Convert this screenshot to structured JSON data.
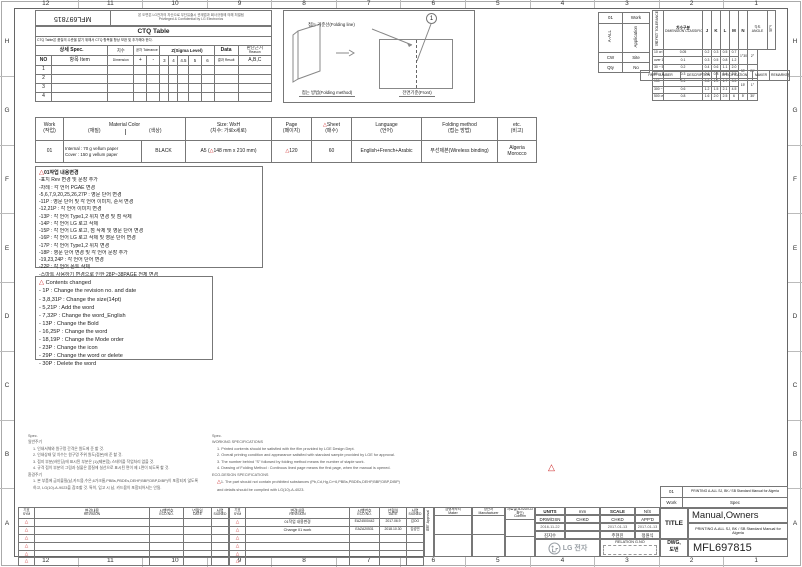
{
  "colors": {
    "accent_red": "#cc2222",
    "line_gray": "#777777",
    "logo_gray": "#9aa0a6"
  },
  "frame": {
    "cols": [
      "12",
      "11",
      "10",
      "9",
      "8",
      "7",
      "6",
      "5",
      "4",
      "3",
      "2",
      "1"
    ],
    "rows": [
      "H",
      "G",
      "F",
      "E",
      "D",
      "C",
      "B",
      "A"
    ]
  },
  "header": {
    "doc_number_flipped": "MFL697815",
    "notice_ko": "본 도면은 LG전자의 자산으로 무단유출시 관계법과 회사규정에 의해 처벌됨",
    "notice_en": "Privileged & Confidential by LG Electronics"
  },
  "ctq": {
    "title": "CTQ Table",
    "note": "CTQ Table은 품질의 수준을 알기 위해서 CTQ 항목을 항상 보완 및 추가해야 한다.",
    "headers": {
      "spec": "상세 Spec.",
      "no": "NO",
      "item": "항목 Item",
      "dim": "치수",
      "dim_sub": "Dimension",
      "tol": "공차 Tolerance",
      "plus": "+",
      "minus": "-",
      "sigma": "Z(Sigma Level)",
      "sigma_levels": [
        "3",
        "4",
        "4.5",
        "5",
        "6"
      ],
      "data_label": "Data",
      "result": "결과 Result",
      "reason_ko": "판단근거",
      "reason_en": "Reason",
      "abc": "A,B,C"
    },
    "row_numbers": [
      "1",
      "2",
      "3",
      "4"
    ]
  },
  "folding_diagram": {
    "callout": "1",
    "folding_line_label": "접는 기준선(Folding line)",
    "method_label": "접는 방법(Folding method)",
    "front_label": "전면기준(Front)"
  },
  "work_table": {
    "rows": [
      [
        "01",
        "Work"
      ],
      [
        "A-ALL",
        "Application"
      ],
      [
        "CW",
        "Site"
      ],
      [
        "Qty",
        "No"
      ]
    ]
  },
  "tolerance_table": {
    "side_label": "일반공차 TOLERANCE",
    "title_ko": "치수구분",
    "title_en": "DIMENSION CLASSIFICATION",
    "cols": [
      "J",
      "K",
      "L",
      "M",
      "N"
    ],
    "angle_ko": "각도",
    "angle_en": "ANGLE",
    "remark": "비고",
    "rows": [
      {
        "range": "10 or less",
        "values": [
          "0.05",
          "0.2",
          "0.3",
          "0.5",
          "0.7"
        ]
      },
      {
        "range": "over 10 ~ 30 or less",
        "values": [
          "0.1",
          "0.3",
          "0.5",
          "0.8",
          "1.2"
        ]
      },
      {
        "range": "30 ~ 50",
        "values": [
          "0.2",
          "0.4",
          "0.6",
          "1.1",
          "2.0"
        ]
      },
      {
        "range": "50 ~ 150",
        "values": [
          "0.3",
          "0.6",
          "0.8",
          "1.4",
          "2.5"
        ]
      },
      {
        "range": "150 ~ 300",
        "values": [
          "0.4",
          "0.8",
          "1.0",
          "1.7",
          "3.5"
        ]
      },
      {
        "range": "300 ~ 500",
        "values": [
          "0.6",
          "1.2",
          "1.5",
          "2.1",
          "4.5"
        ]
      },
      {
        "range": "500 over",
        "values": [
          "0.8",
          "1.6",
          "2.0",
          "2.5",
          "6"
        ]
      }
    ],
    "angle_values": [
      [
        "1°30′",
        "2°"
      ],
      [
        "30′",
        "20′"
      ],
      [
        "15′",
        "1°"
      ],
      [
        "5′",
        "30′"
      ]
    ]
  },
  "part_row": {
    "labels": [
      "PART NUMBER",
      "DESCRIPTION",
      "SPECIFICATION",
      "MAKER",
      "REMARKER"
    ]
  },
  "spec_table": {
    "h": {
      "work_en": "Work",
      "work_ko": "(작업)",
      "material_en": "Material Color",
      "material_ko": "(재질)",
      "color_ko": "(색상)",
      "size_en": "Size: WxH",
      "size_ko": "(치수: 가로x세로)",
      "page_en": "Page",
      "page_ko": "(페이지)",
      "sheet_en": "Sheet",
      "sheet_ko": "(매수)",
      "lang_en": "Language",
      "lang_ko": "(언어)",
      "fold_en": "Folding method",
      "fold_ko": "(접는 방법)",
      "etc_en": "etc.",
      "etc_ko": "(비고)"
    },
    "row": {
      "work": "01",
      "material_line1": "Internal : 70 g vellum paper",
      "material_line2": "Cover : 150 g vellum paper",
      "color": "BLACK",
      "size_prefix": "A5 (",
      "size_marked": "148",
      "size_suffix": " mm x 210 mm)",
      "page": "120",
      "sheet": "60",
      "language": "English+French+Arabic",
      "folding": "무선제본(Wireless binding)",
      "etc_line1": "Algeria",
      "etc_line2": "Morocco"
    }
  },
  "changes_ko": {
    "title": "01작업 내용변경",
    "lines": [
      "-표지 Rev 변경 및 문장 추가",
      "-차례 : 각 언어 PGAE 변경",
      "-5,6,7,9,20,25,26,27P : 영문 단어 변경",
      "-11P : 영문 단어 및 각 언어 이미지, 순서 변경",
      "-12,21P : 각 언어 이미지 변경",
      "-13P : 각 언어 Type1,2 위치 변경 및 점 삭제",
      "-14P : 각 언어 LG 로고 삭제",
      "-15P : 각 언어 LG 로고, 점 삭제 및 영문 단어 변경",
      "-16P : 각 언어 LG 로고 삭제 및 영문 단어 변경",
      "-17P : 각 언어 Type1,2 위치 변경",
      "-18P : 영문 단어 변경 및 각 언어 문장 추가",
      "-19,23,24P : 각 언어 단어 변경",
      "-22P : 각 언어 폰트 삭제",
      "-스마트 사용하기 변경으로 인한 28P~38PAGE 전체 변경"
    ]
  },
  "changes_en": {
    "title": "Contents changed",
    "lines": [
      "- 1P : Change the revision no. and date",
      "- 3,8,31P : Change the size(14pt)",
      "- 5,21P : Add the word",
      "- 7,32P : Change the word_English",
      "- 13P : Change the Bold",
      "- 16,25P : Change the word",
      "- 18,19P : Change the Mode order",
      "- 23P : Change the icon",
      "- 29P : Change the word or delete",
      "- 30P : Delete the word"
    ]
  },
  "notes_left": {
    "title": "Spec.",
    "sections": [
      {
        "heading": "일반주기",
        "lines": [
          "1. 인쇄서체와 원구멍 간격은 원도에 준 할 것.",
          "2. 인쇄상태 및 치수는 원구멍 주위 원도(접본)에 준 할 것.",
          "3. 접지 부분(바인딩)에 표시된 부분은 (1)(제본점) 스테이플 작업처리 없을 것.",
          "4. 규격 접이 부분의 그림과 실물은 품질에 실선으로 표시된 면이 제 1면이 되도록 할 것."
        ]
      },
      {
        "heading": "환경주기",
        "lines": [
          "1. 본 부품에 금지물질(납,카드뮴,수은,6가크롬,PBBs,PBDEs,DEHP,BBP,DBP,DIBP)이 포함되지 않도록",
          "    하고, LG(10)-A-9023을 참조할 것. 특히, 입고 시 납, 카드뮴이 포함되어서는 안됨."
        ]
      }
    ]
  },
  "notes_mid": {
    "title": "Spec.",
    "sections": [
      {
        "heading": "WORKING SPECIFICATIONS",
        "lines": [
          "1. Printed contents should be satisfied with the film provided by LGE Design Dept.",
          "2. Overall printing condition and appearance satisfied with standard sample provided by LGE for approval.",
          "3. The number behind \"S\" followed by folding method means the number of staple work.",
          "4. Drawing of Folding Method : Continous lined page means the first page, when the manual is opened."
        ]
      },
      {
        "heading": "ECO-DESIGN SPECIFICATIONS",
        "tri_first": true,
        "lines": [
          "1. The part should not contain prohibited substances (Pb,Cd,Hg,Cr+6,PBBs,PBDEs,DEHP,BBP,DBP,DIBP)",
          "and details should be complied with LG(10)-A-4023."
        ]
      }
    ]
  },
  "revision_tables": {
    "headers": {
      "sym_ko": "기호",
      "sym_en": "SYM",
      "rev_ko": "변경내용",
      "rev_en": "REVISION",
      "eco_ko": "시행번호",
      "eco_en": "ECO.NO.",
      "date_ko": "년월일",
      "date_en": "DATE",
      "signed_ko": "서명",
      "signed_en": "SIGNED"
    },
    "row_count": 6,
    "right_rows": [
      {
        "revision": "01작업 내용변경",
        "eco_no": "EAZ4500442",
        "date": "2017.06.9",
        "signed": "김OO"
      },
      {
        "revision": "Change 01 work",
        "eco_no": "EAZA20531",
        "date": "2018.10.30",
        "signed": "김성민"
      },
      {},
      {},
      {},
      {}
    ]
  },
  "title_block": {
    "approval_ko": "합의",
    "approval_en": "Approval",
    "maker_ko": "금형제작처",
    "maker_en": "Maker",
    "manufacturer_ko": "양산처",
    "manufacturer_en": "Manufacturer",
    "confirm_ko": "자료실(3D/2D/CD확인)",
    "confirm_en": "Confirm",
    "units_label": "UNITS",
    "units_value": "mm",
    "scale_label": "SCALE",
    "scale_value": "N/S",
    "drw_label": "DRW/DSN",
    "chkd_label": "CHKD",
    "chkd2_label": "CHKD",
    "appd_label": "APP'D",
    "drw_date": "2016-11-22",
    "drw_name": "김지수",
    "chkd2_date": "2017-01-13",
    "chkd2_name": "주현진",
    "appd_date": "2017-01-13",
    "appd_name": "정원식",
    "logo_text": "LG 전자",
    "relation_label": "RELATION G.NO",
    "title_label": "TITLE",
    "title": "Manual,Owners",
    "subtitle": "PRINTING A-ALL SJ, BK / SB Standard Manual for Algeria",
    "dwg_label_1": "DWG,",
    "dwg_label_2": "도번",
    "dwg_no": "MFL697815",
    "mini": {
      "work_no": "01",
      "spec_text": "PRINTING A-ALL SJ, BK / SB Standard Manual for Algeria",
      "work_label": "Work",
      "spec_label": "Spec"
    }
  }
}
